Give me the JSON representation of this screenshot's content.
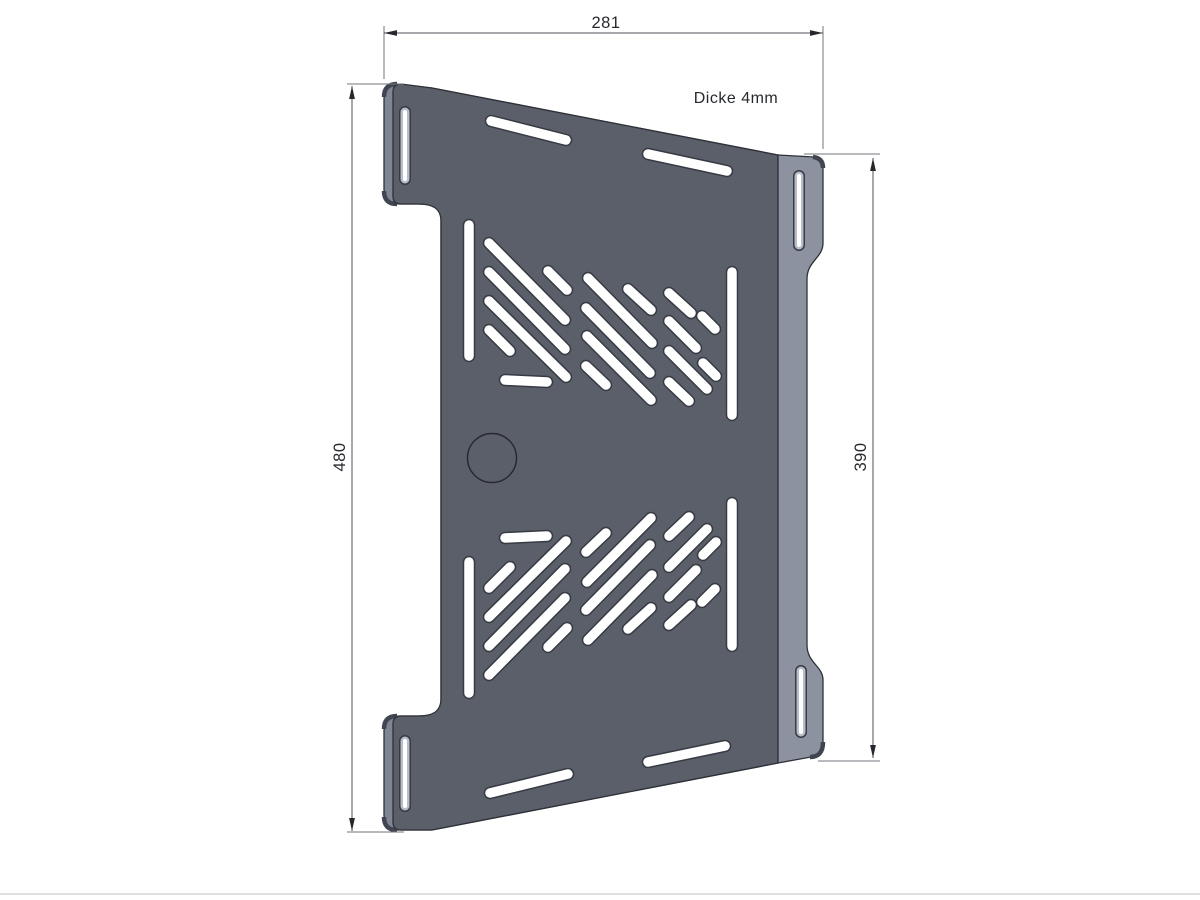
{
  "drawing": {
    "labels": {
      "width": "281",
      "height_left": "480",
      "height_right": "390",
      "thickness_note": "Dicke 4mm"
    },
    "colors": {
      "background": "#ffffff",
      "face": "#5a5f6a",
      "flange": "#8c92a0",
      "edge_sliver": "#7e8594",
      "corner_shade": "#41454f",
      "outline": "#2e3138",
      "slot_rim": "#363a42",
      "slot_fill": "#ffffff",
      "tab_slot_fill": "#b7bdc9",
      "tab_slot_core": "#ffffff",
      "hole_stroke": "#26282e",
      "dim_line": "#4e5157",
      "ext_line": "#73767c",
      "arrow": "#26282d",
      "text": "#26292e",
      "page_edge": "#d4d6d9"
    },
    "plate": {
      "silhouette_path": "M 397,84 L 432,88 L 778,155 L 778,763 L 432,830 L 399,830 Q 384,830 384,815 L 384,731 Q 384,716 399,716 L 419,716 C 432,716 441,712 441,699 L 441,221 C 441,208 432,204 419,204 L 399,204 Q 384,204 384,189 L 384,99 Q 384,84 397,84 Z",
      "face_path": "M 401,84 L 432,88 L 778,155 L 778,763 L 432,830 L 401,830 Q 393,830 393,822 L 393,724 Q 393,716 401,716 L 419,716 C 432,716 441,712 441,699 L 441,221 C 441,208 432,204 419,204 L 401,204 Q 393,204 393,196 L 393,92 Q 393,84 401,84 Z",
      "flange_path": "M 778,155 L 814,157 Q 823,158 823,167 L 823,243 C 823,258 807,261 807,279 L 807,645 C 807,663 823,666 823,680 L 823,743 Q 823,756 811,757 L 778,763 Z",
      "corner_bands": [
        "M 384,97 Q 384,84 397,84",
        "M 384,191 Q 384,204 397,204",
        "M 384,729 Q 384,716 397,716",
        "M 384,817 Q 384,830 397,830",
        "M 813,157 Q 823,158 823,168",
        "M 823,742 Q 823,757 810,757"
      ],
      "face_slots": [
        [
          491,
          121,
          566,
          140
        ],
        [
          648,
          154,
          727,
          171
        ],
        [
          490,
          793,
          568,
          774
        ],
        [
          648,
          762,
          725,
          746
        ],
        [
          469,
          225,
          469,
          356
        ],
        [
          548,
          271,
          567,
          290
        ],
        [
          489,
          243,
          565,
          320
        ],
        [
          489,
          272,
          565,
          349
        ],
        [
          489,
          301,
          566,
          377
        ],
        [
          489,
          330,
          510,
          351
        ],
        [
          505,
          380,
          547,
          382
        ],
        [
          628,
          289,
          651,
          310
        ],
        [
          588,
          278,
          652,
          343
        ],
        [
          586,
          308,
          650,
          373
        ],
        [
          587,
          336,
          651,
          400
        ],
        [
          586,
          366,
          606,
          385
        ],
        [
          669,
          293,
          691,
          313
        ],
        [
          702,
          316,
          715,
          329
        ],
        [
          669,
          321,
          696,
          348
        ],
        [
          669,
          351,
          707,
          389
        ],
        [
          703,
          363,
          716,
          376
        ],
        [
          669,
          382,
          689,
          401
        ],
        [
          732,
          272,
          732,
          415
        ],
        [
          469,
          562,
          469,
          693
        ],
        [
          548,
          647,
          567,
          628
        ],
        [
          489,
          675,
          565,
          598
        ],
        [
          489,
          646,
          565,
          569
        ],
        [
          489,
          617,
          566,
          541
        ],
        [
          489,
          588,
          510,
          567
        ],
        [
          505,
          538,
          547,
          536
        ],
        [
          628,
          629,
          651,
          608
        ],
        [
          588,
          640,
          652,
          575
        ],
        [
          586,
          610,
          650,
          545
        ],
        [
          587,
          582,
          651,
          518
        ],
        [
          586,
          552,
          606,
          533
        ],
        [
          669,
          625,
          691,
          605
        ],
        [
          702,
          602,
          715,
          589
        ],
        [
          669,
          597,
          696,
          570
        ],
        [
          669,
          567,
          707,
          529
        ],
        [
          703,
          555,
          716,
          542
        ],
        [
          669,
          536,
          689,
          517
        ],
        [
          732,
          503,
          732,
          646
        ]
      ],
      "tab_slots": [
        [
          405,
          112,
          405,
          179
        ],
        [
          405,
          741,
          405,
          806
        ],
        [
          799,
          176,
          799,
          245
        ],
        [
          801,
          671,
          801,
          732
        ]
      ],
      "hole_circle": {
        "cx": 492,
        "cy": 458,
        "r": 24.5
      }
    },
    "dimensions_geometry": {
      "top": {
        "line": [
          384,
          33,
          823,
          33
        ],
        "arrows": [
          [
            "left",
            384,
            33
          ],
          [
            "right",
            823,
            33
          ]
        ],
        "ext": [
          [
            384,
            26,
            384,
            79
          ],
          [
            823,
            26,
            823,
            149
          ]
        ]
      },
      "left": {
        "line": [
          352,
          86,
          352,
          831
        ],
        "arrows": [
          [
            "up",
            352,
            86
          ],
          [
            "down",
            352,
            831
          ]
        ],
        "ext": [
          [
            347,
            84,
            404,
            84
          ],
          [
            347,
            832,
            404,
            832
          ]
        ]
      },
      "right": {
        "line": [
          873,
          158,
          873,
          758
        ],
        "arrows": [
          [
            "up",
            873,
            158
          ],
          [
            "down",
            873,
            758
          ]
        ],
        "ext": [
          [
            804,
            154,
            880,
            154
          ],
          [
            818,
            761,
            880,
            761
          ]
        ]
      }
    },
    "page_edge_y": 894
  }
}
